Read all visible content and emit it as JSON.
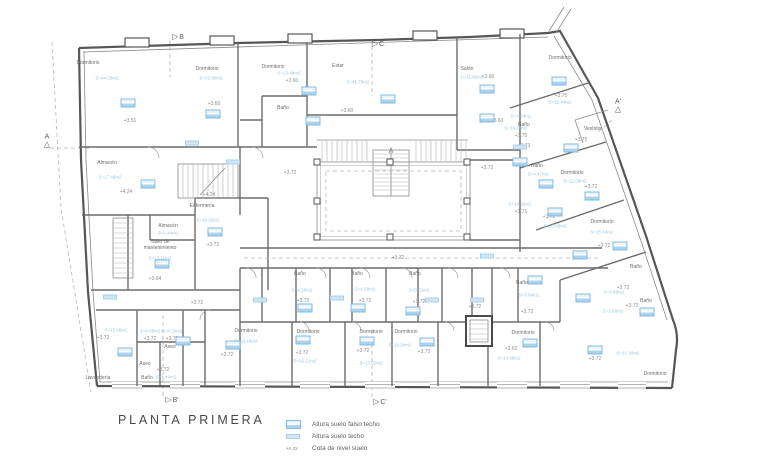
{
  "title": "PLANTA PRIMERA",
  "legend": {
    "items": [
      {
        "symbol": "ceiling-height-box",
        "label": "Altura suelo falso techo"
      },
      {
        "symbol": "floor-height-box",
        "label": "Altura suelo techo"
      },
      {
        "symbol": "+x.xx",
        "label": "Cota de nivel suelo",
        "symbol_text": "+x.xx"
      }
    ]
  },
  "colors": {
    "annotation_blue": "#85bade",
    "annotation_blue_light": "#cfe6f6",
    "area_text_blue": "#94c5e7",
    "wall_gray": "#565656",
    "text_gray": "#6c6c6c"
  },
  "section_markers": [
    {
      "label": "B",
      "x": 178,
      "y": 37,
      "orient": "right"
    },
    {
      "label": "C",
      "x": 378,
      "y": 44,
      "orient": "right"
    },
    {
      "label": "A",
      "x": 47,
      "y": 141,
      "orient": "up"
    },
    {
      "label": "A'",
      "x": 618,
      "y": 106,
      "orient": "up"
    },
    {
      "label": "B'",
      "x": 172,
      "y": 400,
      "orient": "right"
    },
    {
      "label": "C'",
      "x": 380,
      "y": 402,
      "orient": "right"
    }
  ],
  "plan": {
    "rooms": [
      {
        "text": "Dormitorio",
        "x": 88,
        "y": 63
      },
      {
        "text": "Dormitorio",
        "x": 207,
        "y": 69
      },
      {
        "text": "Dormitorio",
        "x": 273,
        "y": 67
      },
      {
        "text": "Estar",
        "x": 338,
        "y": 66
      },
      {
        "text": "Salón",
        "x": 467,
        "y": 69
      },
      {
        "text": "Dormitorio",
        "x": 560,
        "y": 58
      },
      {
        "text": "Baño",
        "x": 283,
        "y": 108
      },
      {
        "text": "Baño",
        "x": 524,
        "y": 125
      },
      {
        "text": "Vestidor",
        "x": 593,
        "y": 129
      },
      {
        "text": "Baño",
        "x": 537,
        "y": 166
      },
      {
        "text": "Dormitorio",
        "x": 572,
        "y": 173
      },
      {
        "text": "Dormitorio",
        "x": 602,
        "y": 222
      },
      {
        "text": "Almacén",
        "x": 107,
        "y": 163
      },
      {
        "text": "Enfermería",
        "x": 202,
        "y": 206
      },
      {
        "text": "Almacén",
        "x": 168,
        "y": 226
      },
      {
        "text": "Taller de\nmantenimiento",
        "x": 160,
        "y": 245
      },
      {
        "text": "Lavandería",
        "x": 98,
        "y": 378
      },
      {
        "text": "Baño",
        "x": 147,
        "y": 378
      },
      {
        "text": "Aseo",
        "x": 145,
        "y": 364
      },
      {
        "text": "Aseo",
        "x": 170,
        "y": 347
      },
      {
        "text": "Dormitorio",
        "x": 246,
        "y": 331
      },
      {
        "text": "Baño",
        "x": 300,
        "y": 274
      },
      {
        "text": "Baño",
        "x": 357,
        "y": 274
      },
      {
        "text": "Baño",
        "x": 415,
        "y": 274
      },
      {
        "text": "Baño",
        "x": 522,
        "y": 283
      },
      {
        "text": "Baño",
        "x": 636,
        "y": 267
      },
      {
        "text": "Baño",
        "x": 646,
        "y": 301
      },
      {
        "text": "Dormitorio",
        "x": 308,
        "y": 332
      },
      {
        "text": "Dormitorio",
        "x": 371,
        "y": 332
      },
      {
        "text": "Dormitorio",
        "x": 406,
        "y": 332
      },
      {
        "text": "Dormitorio",
        "x": 523,
        "y": 333
      },
      {
        "text": "Dormitorio",
        "x": 655,
        "y": 374
      }
    ],
    "levels": [
      {
        "text": "+3.51",
        "x": 130,
        "y": 121
      },
      {
        "text": "+3.60",
        "x": 214,
        "y": 104
      },
      {
        "text": "+3.60",
        "x": 292,
        "y": 81
      },
      {
        "text": "+3.60",
        "x": 347,
        "y": 111
      },
      {
        "text": "+3.60",
        "x": 488,
        "y": 77
      },
      {
        "text": "+3.60",
        "x": 497,
        "y": 121
      },
      {
        "text": "+3.75",
        "x": 521,
        "y": 136
      },
      {
        "text": "+3.75",
        "x": 561,
        "y": 96
      },
      {
        "text": "+3.75",
        "x": 581,
        "y": 140
      },
      {
        "text": "+3.73",
        "x": 524,
        "y": 146
      },
      {
        "text": "+3.72",
        "x": 591,
        "y": 187
      },
      {
        "text": "+3.72",
        "x": 604,
        "y": 246
      },
      {
        "text": "+1.71",
        "x": 521,
        "y": 212
      },
      {
        "text": "+3.72",
        "x": 549,
        "y": 217
      },
      {
        "text": "+4.24",
        "x": 126,
        "y": 192
      },
      {
        "text": "+4.24",
        "x": 209,
        "y": 195
      },
      {
        "text": "+3.72",
        "x": 213,
        "y": 245
      },
      {
        "text": "+3.94",
        "x": 155,
        "y": 279
      },
      {
        "text": "+3.72",
        "x": 197,
        "y": 303
      },
      {
        "text": "+3.72",
        "x": 103,
        "y": 338
      },
      {
        "text": "+3.72",
        "x": 150,
        "y": 339
      },
      {
        "text": "+3.72",
        "x": 172,
        "y": 339
      },
      {
        "text": "+3.72",
        "x": 163,
        "y": 370
      },
      {
        "text": "+3.72",
        "x": 227,
        "y": 355
      },
      {
        "text": "+3.72",
        "x": 290,
        "y": 173
      },
      {
        "text": "+3.72",
        "x": 487,
        "y": 168
      },
      {
        "text": "+3.72",
        "x": 398,
        "y": 258
      },
      {
        "text": "+3.72",
        "x": 303,
        "y": 301
      },
      {
        "text": "+3.72",
        "x": 365,
        "y": 301
      },
      {
        "text": "+3.72",
        "x": 419,
        "y": 302
      },
      {
        "text": "+3.72",
        "x": 302,
        "y": 353
      },
      {
        "text": "+3.72",
        "x": 363,
        "y": 351
      },
      {
        "text": "+3.72",
        "x": 424,
        "y": 352
      },
      {
        "text": "+3.62",
        "x": 511,
        "y": 349
      },
      {
        "text": "+3.72",
        "x": 475,
        "y": 307
      },
      {
        "text": "+3.72",
        "x": 527,
        "y": 312
      },
      {
        "text": "+3.72",
        "x": 623,
        "y": 288
      },
      {
        "text": "+3.72",
        "x": 632,
        "y": 306
      },
      {
        "text": "+3.72",
        "x": 595,
        "y": 359
      }
    ],
    "areas": [
      {
        "text": "S=44.33m2",
        "x": 107,
        "y": 78
      },
      {
        "text": "S=15.60m2",
        "x": 211,
        "y": 78
      },
      {
        "text": "S=13.48m2",
        "x": 289,
        "y": 73
      },
      {
        "text": "S=41.78m2",
        "x": 358,
        "y": 82
      },
      {
        "text": "S=11.85m2",
        "x": 472,
        "y": 77
      },
      {
        "text": "S=4.84m2",
        "x": 521,
        "y": 116
      },
      {
        "text": "S=15.44m2",
        "x": 560,
        "y": 102
      },
      {
        "text": "S=16.88m2",
        "x": 516,
        "y": 128
      },
      {
        "text": "S=4.47m2",
        "x": 538,
        "y": 174
      },
      {
        "text": "S=12.68m2",
        "x": 575,
        "y": 181
      },
      {
        "text": "S=10.91m2",
        "x": 520,
        "y": 204
      },
      {
        "text": "S=10.08m2",
        "x": 555,
        "y": 226
      },
      {
        "text": "S=15.64m2",
        "x": 602,
        "y": 232
      },
      {
        "text": "S=17.46m2",
        "x": 110,
        "y": 177
      },
      {
        "text": "S=18.22m2",
        "x": 208,
        "y": 220
      },
      {
        "text": "S=2.48m2",
        "x": 168,
        "y": 233
      },
      {
        "text": "S=13.11m2",
        "x": 160,
        "y": 258
      },
      {
        "text": "S=12.06m2",
        "x": 116,
        "y": 330
      },
      {
        "text": "S=4.06m2",
        "x": 150,
        "y": 331
      },
      {
        "text": "S=4.29m2",
        "x": 172,
        "y": 331
      },
      {
        "text": "S=4.46m2",
        "x": 166,
        "y": 377
      },
      {
        "text": "S=14.16m2",
        "x": 246,
        "y": 341
      },
      {
        "text": "S=4.28m2",
        "x": 302,
        "y": 290
      },
      {
        "text": "S=4.29m2",
        "x": 365,
        "y": 289
      },
      {
        "text": "S=5.22m2",
        "x": 419,
        "y": 290
      },
      {
        "text": "S=16.22m2",
        "x": 305,
        "y": 361
      },
      {
        "text": "S=17.02m2",
        "x": 371,
        "y": 363
      },
      {
        "text": "S=18.30m2",
        "x": 400,
        "y": 345
      },
      {
        "text": "S=3.94m2",
        "x": 529,
        "y": 295
      },
      {
        "text": "S=14.98m2",
        "x": 509,
        "y": 358
      },
      {
        "text": "S=4.86m2",
        "x": 614,
        "y": 292
      },
      {
        "text": "S=3.86m2",
        "x": 613,
        "y": 311
      },
      {
        "text": "S=21.36m2",
        "x": 628,
        "y": 353
      }
    ],
    "boxes": [
      {
        "type": "ceiling",
        "x": 128,
        "y": 103
      },
      {
        "type": "ceiling",
        "x": 213,
        "y": 114
      },
      {
        "type": "ceiling",
        "x": 309,
        "y": 91
      },
      {
        "type": "ceiling",
        "x": 388,
        "y": 99
      },
      {
        "type": "ceiling",
        "x": 487,
        "y": 89
      },
      {
        "type": "ceiling",
        "x": 487,
        "y": 118
      },
      {
        "type": "ceiling",
        "x": 559,
        "y": 81
      },
      {
        "type": "ceiling",
        "x": 313,
        "y": 121
      },
      {
        "type": "ceiling",
        "x": 520,
        "y": 162
      },
      {
        "type": "ceiling",
        "x": 546,
        "y": 184
      },
      {
        "type": "ceiling",
        "x": 592,
        "y": 196
      },
      {
        "type": "ceiling",
        "x": 620,
        "y": 246
      },
      {
        "type": "ceiling",
        "x": 571,
        "y": 148
      },
      {
        "type": "ceiling",
        "x": 555,
        "y": 212
      },
      {
        "type": "ceiling",
        "x": 580,
        "y": 255
      },
      {
        "type": "ceiling",
        "x": 148,
        "y": 184
      },
      {
        "type": "ceiling",
        "x": 215,
        "y": 232
      },
      {
        "type": "ceiling",
        "x": 162,
        "y": 264
      },
      {
        "type": "ceiling",
        "x": 125,
        "y": 352
      },
      {
        "type": "ceiling",
        "x": 183,
        "y": 341
      },
      {
        "type": "ceiling",
        "x": 233,
        "y": 345
      },
      {
        "type": "ceiling",
        "x": 305,
        "y": 308
      },
      {
        "type": "ceiling",
        "x": 358,
        "y": 308
      },
      {
        "type": "ceiling",
        "x": 413,
        "y": 311
      },
      {
        "type": "ceiling",
        "x": 303,
        "y": 340
      },
      {
        "type": "ceiling",
        "x": 367,
        "y": 341
      },
      {
        "type": "ceiling",
        "x": 427,
        "y": 342
      },
      {
        "type": "ceiling",
        "x": 535,
        "y": 280
      },
      {
        "type": "ceiling",
        "x": 583,
        "y": 298
      },
      {
        "type": "ceiling",
        "x": 647,
        "y": 312
      },
      {
        "type": "ceiling",
        "x": 595,
        "y": 350
      },
      {
        "type": "ceiling",
        "x": 530,
        "y": 343
      },
      {
        "type": "floor",
        "x": 192,
        "y": 143
      },
      {
        "type": "floor",
        "x": 233,
        "y": 162
      },
      {
        "type": "floor",
        "x": 110,
        "y": 297
      },
      {
        "type": "floor",
        "x": 260,
        "y": 300
      },
      {
        "type": "floor",
        "x": 337,
        "y": 298
      },
      {
        "type": "floor",
        "x": 432,
        "y": 300
      },
      {
        "type": "floor",
        "x": 477,
        "y": 300
      },
      {
        "type": "floor",
        "x": 487,
        "y": 256
      },
      {
        "type": "floor",
        "x": 520,
        "y": 147
      }
    ]
  }
}
